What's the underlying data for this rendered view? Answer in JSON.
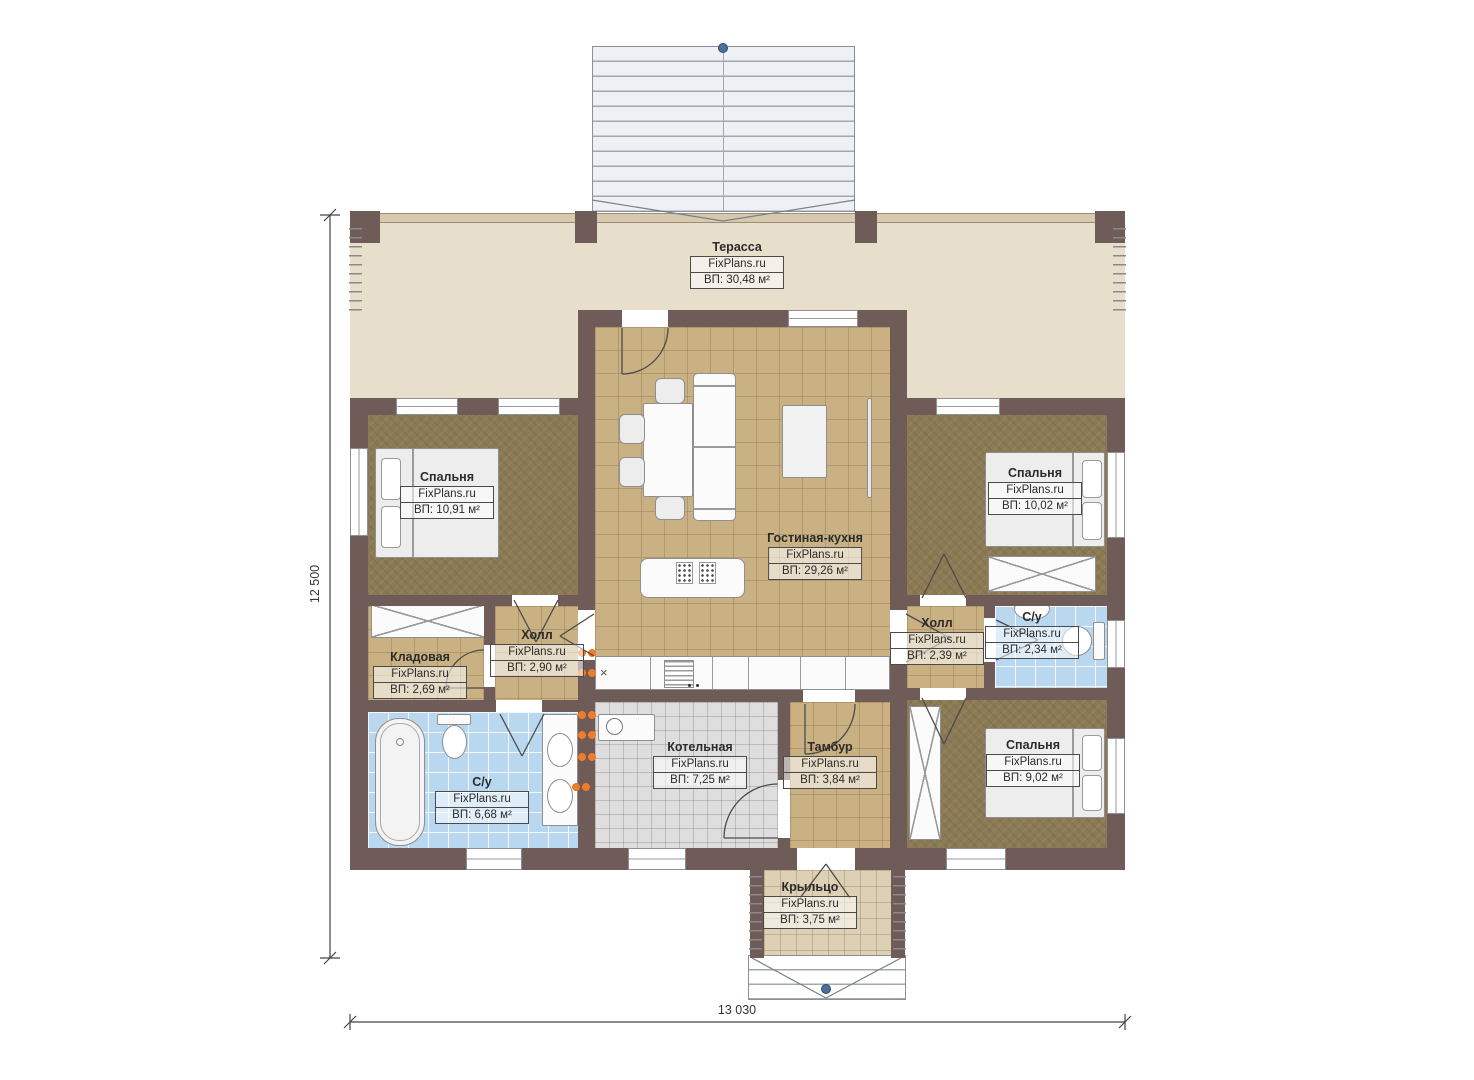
{
  "dimensions": {
    "height": "12 500",
    "width": "13 030"
  },
  "rooms": [
    {
      "name": "Терасса",
      "site": "FixPlans.ru",
      "area": "ВП: 30,48 м²"
    },
    {
      "name": "Спальня",
      "site": "FixPlans.ru",
      "area": "ВП: 10,91 м²"
    },
    {
      "name": "Спальня",
      "site": "FixPlans.ru",
      "area": "ВП: 10,02 м²"
    },
    {
      "name": "Гостиная-кухня",
      "site": "FixPlans.ru",
      "area": "ВП: 29,26 м²"
    },
    {
      "name": "Холл",
      "site": "FixPlans.ru",
      "area": "ВП: 2,90 м²"
    },
    {
      "name": "Кладовая",
      "site": "FixPlans.ru",
      "area": "ВП: 2,69 м²"
    },
    {
      "name": "С/у",
      "site": "FixPlans.ru",
      "area": "ВП: 6,68 м²"
    },
    {
      "name": "Котельная",
      "site": "FixPlans.ru",
      "area": "ВП: 7,25 м²"
    },
    {
      "name": "Тамбур",
      "site": "FixPlans.ru",
      "area": "ВП: 3,84 м²"
    },
    {
      "name": "Холл",
      "site": "FixPlans.ru",
      "area": "ВП: 2,39 м²"
    },
    {
      "name": "С/у",
      "site": "FixPlans.ru",
      "area": "ВП: 2,34 м²"
    },
    {
      "name": "Спальня",
      "site": "FixPlans.ru",
      "area": "ВП: 9,02 м²"
    },
    {
      "name": "Крыльцо",
      "site": "FixPlans.ru",
      "area": "ВП: 3,75 м²"
    }
  ],
  "symbols": {
    "cross": "×"
  },
  "colors": {
    "wall": "#6f5b57",
    "terrace": "#e7decb",
    "tile": "#c9b183",
    "carpet": "#8b7a54",
    "wet": "#b9d8f0",
    "boiler": "#dedede",
    "radiator": "#f07c28",
    "marker": "#4d6f9d"
  }
}
